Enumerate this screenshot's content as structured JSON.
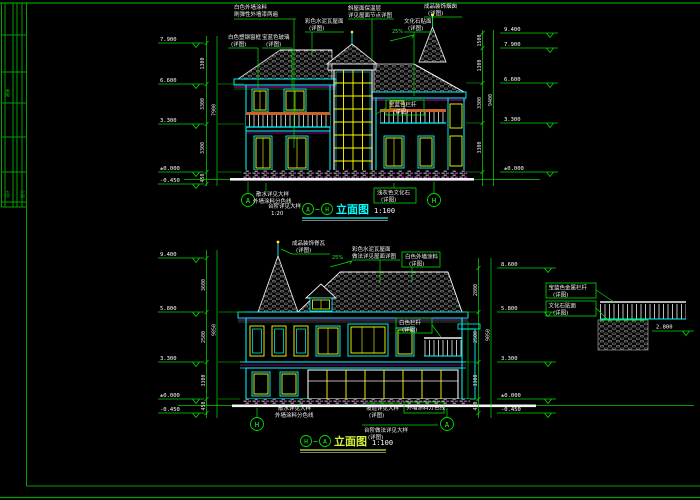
{
  "colors": {
    "background": "#000000",
    "frame_green": "#00a000",
    "annotation_green": "#00dd00",
    "wall_cyan": "#00ffff",
    "window_yellow": "#ffff00",
    "trim_magenta": "#ff00ff",
    "linework_white": "#f5f5f5",
    "rail_orange": "#c9622a"
  },
  "sheet": {
    "side_label": "建施",
    "cell_a": "设计",
    "cell_b": "图号"
  },
  "top": {
    "axis_left": "A",
    "axis_right": "H",
    "tilde": "~",
    "title": "立面图",
    "scale": "1:100",
    "slope": "25%",
    "levels_left": [
      "7.900",
      "6.600",
      "3.300",
      "±0.000",
      "-0.450"
    ],
    "levels_right": [
      "9.400",
      "7.900",
      "6.600",
      "3.300",
      "±0.000"
    ],
    "dims_left": [
      "1300",
      "3300",
      "3300",
      "450"
    ],
    "dims_right": [
      "1500",
      "1300",
      "3300",
      "3300"
    ],
    "total_left": "7900",
    "total_right": "9400",
    "ann": [
      {
        "a": "白色外墙涂料",
        "b": "刷弹性外墙漆两遍"
      },
      {
        "a": "彩色水泥瓦屋面",
        "b": "(详图)"
      },
      {
        "a": "斜屋面保温层",
        "b": "详见屋面节点详图"
      },
      {
        "a": "成品装饰烟囱",
        "b": "(详图)"
      },
      {
        "a": "白色塑钢窗框",
        "b": "(详图)"
      },
      {
        "a": "宝蓝色玻璃",
        "b": "(详图)"
      },
      {
        "a": "文化石贴面",
        "b": "(详图)"
      },
      {
        "a": "宝蓝色栏杆",
        "b": "(详图)"
      }
    ],
    "foot": [
      {
        "a": "散水详见大样",
        "b": "外墙涂料分色线"
      },
      {
        "a": "台阶详见大样",
        "b": "1:20"
      },
      {
        "a": "浅灰色文化石",
        "b": "(详图)"
      }
    ]
  },
  "bottom": {
    "axis_left": "H",
    "axis_right": "A",
    "tilde": "~",
    "title": "立面图",
    "scale": "1:100",
    "slope": "25%",
    "terrace_level": "2.800",
    "levels_left": [
      "9.400",
      "5.800",
      "3.300",
      "±0.000",
      "-0.450"
    ],
    "levels_right": [
      "8.600",
      "5.800",
      "3.300",
      "±0.000",
      "-0.450"
    ],
    "dims_left": [
      "3600",
      "2500",
      "3300",
      "450"
    ],
    "dims_right": [
      "2800",
      "2500",
      "3300",
      "450"
    ],
    "total_left": "9850",
    "total_right": "9050",
    "ann": [
      {
        "a": "成品装饰脊瓦",
        "b": "(详图)"
      },
      {
        "a": "彩色水泥瓦屋面",
        "b": "做法详见屋面详图"
      },
      {
        "a": "白色外墙涂料",
        "b": "(详图)"
      },
      {
        "a": "宝蓝色金属栏杆",
        "b": "(详图)"
      },
      {
        "a": "文化石贴面",
        "b": "(详图)"
      },
      {
        "a": "白色栏杆",
        "b": "(详图)"
      }
    ],
    "foot": [
      {
        "a": "散水详见大样",
        "b": "外墙涂料分色线"
      },
      {
        "a": "坡道详见大样",
        "b": "(详图)"
      },
      {
        "a": "外墙涂料分色线",
        "b": ""
      },
      {
        "a": "台阶做法详见大样",
        "b": "(详图)"
      }
    ]
  }
}
